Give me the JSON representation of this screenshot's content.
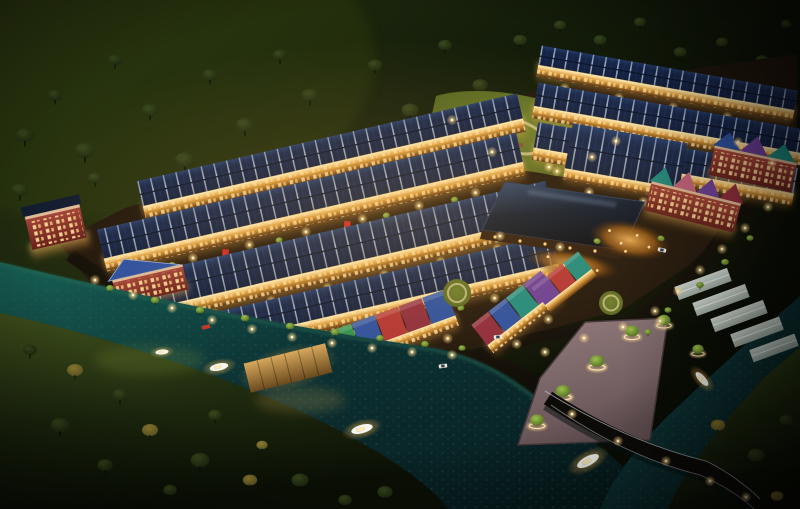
{
  "scene": {
    "type": "3d-architectural-rendering",
    "subject": "riverside-residential-estate",
    "time_of_day": "night",
    "view": "aerial-oblique"
  },
  "inventory": {
    "housing_rows": 8,
    "waterfront_gable_segments": 13,
    "corner_buildings": 4,
    "clubhouse": 1,
    "central_garden": 1,
    "pocket_lawns": 3,
    "plazas": 2,
    "boats": 5,
    "bridge": 1,
    "dock": 1,
    "promenade_ring_trees": 6,
    "phase2_white_structures": 5,
    "cars": 4,
    "red_umbrellas": 5,
    "gazebos": 2,
    "streetlights": 70,
    "background_trees": 46
  },
  "palette": {
    "bg1": "#2a3512",
    "bg2": "#151e0a",
    "bg3": "#090c04",
    "moss": "#33400f",
    "treeDark": "#1c270e",
    "treeDarkHi": "#36461b",
    "treeLit": "#4e6a20",
    "treeLitHi": "#9cc04c",
    "treeAmber": "#5e5524",
    "treeAmberHi": "#8f7e30",
    "bank": "#1d280e",
    "bankLit": "#3f501c",
    "water1": "#0d3234",
    "water2": "#176054",
    "water3": "#061a1c",
    "waterSpeck": "#2e7668",
    "estateGround": "#20160c",
    "street": "#120e08",
    "road": "#0f0c08",
    "bridge": "#0d0b08",
    "rail": "#d8dde2",
    "roofNavy": "#16254a",
    "roofNavyDk": "#0c1528",
    "roofSeam": "#cdd9e8",
    "roofSheen": "#3e62a0",
    "facade1": "#fff1bd",
    "facade2": "#d9993a",
    "facade3": "#54300e",
    "glowA": "#ffd87e",
    "glowB": "#ff9d2e",
    "lamp": "#ffd98a",
    "brickA": "#a8463a",
    "brickB": "#651f1a",
    "cream": "#ecd9b0",
    "gableTeal": "#1e8a7e",
    "gableGreen": "#2f9150",
    "gableBlue": "#2b4fa0",
    "gableRed": "#b23434",
    "gableMaroon": "#8e2b3c",
    "gablePurple": "#6a3d96",
    "gablePink": "#c2607e",
    "clubRoof": "#0e1a2e",
    "clubSheen": "#31486e",
    "park": "#51611e",
    "parkHi": "#6d7e2c",
    "parkPath": "#cabe86",
    "prom1": "#937c7e",
    "prom2": "#655254",
    "promEdge": "#46383a",
    "white1": "#e9f0ea",
    "white2": "#b3c0b6",
    "boatHull": "#f4f6f1",
    "boatGlow": "#ffdf96",
    "umbRed": "#cc2722",
    "carWhite": "#e8e8e2",
    "carRed": "#c03a2a",
    "wood1": "#d8a85c",
    "wood2": "#6a4a1e",
    "plaza1": "#f0b054",
    "plaza2": "#9a5a14"
  }
}
